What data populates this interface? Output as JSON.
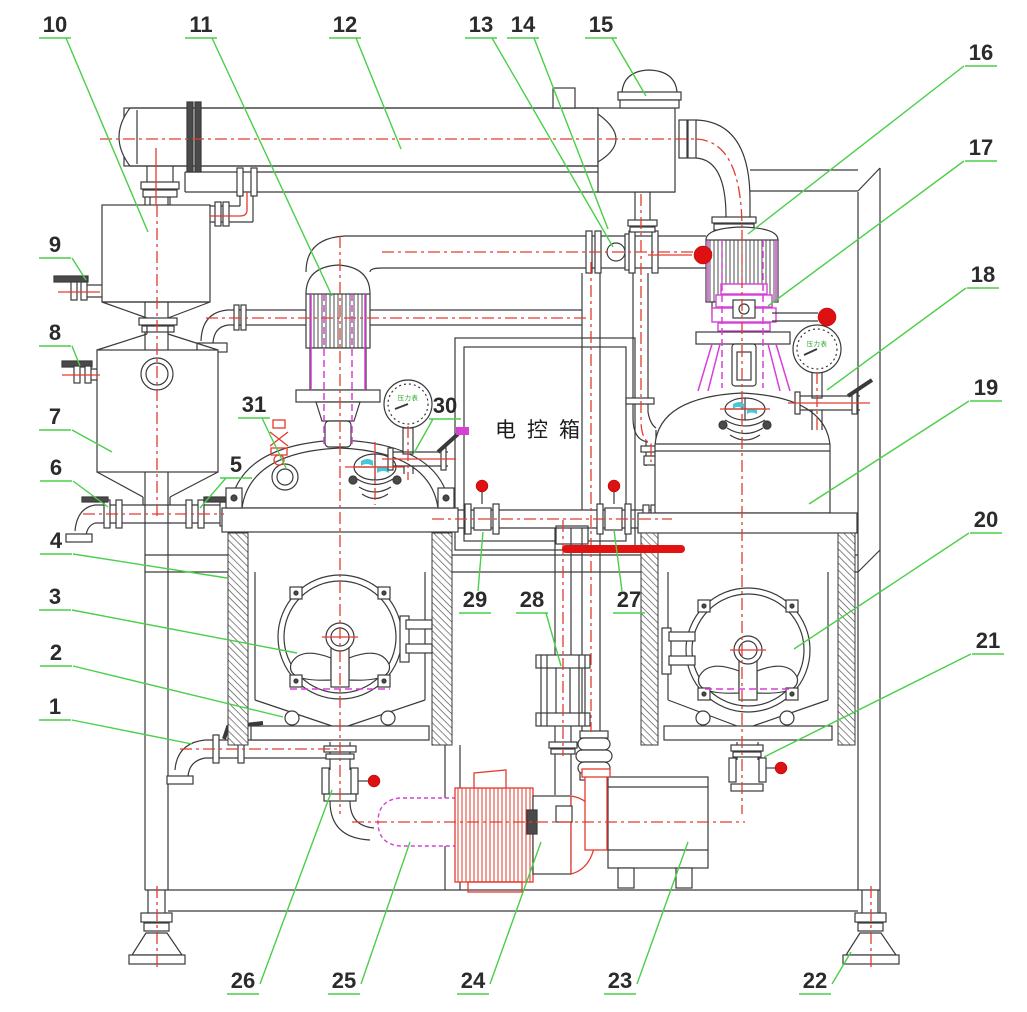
{
  "figure": {
    "type": "engineering-assembly-diagram",
    "control_box_label": "电控箱",
    "gauge_label": "压力表",
    "colors": {
      "leader_green": "#49cf49",
      "line_black": "#3a3a3a",
      "pipe_red": "#e23b30",
      "magenta": "#d640d6",
      "ball_red": "#dd1111",
      "bar_red": "#e01212",
      "cyan": "#45c8d8"
    },
    "callouts": [
      {
        "n": "1",
        "x": 55,
        "y": 714,
        "sx": 72,
        "sy": 720,
        "ex": 192,
        "ey": 744
      },
      {
        "n": "2",
        "x": 56,
        "y": 660,
        "sx": 73,
        "sy": 666,
        "ex": 283,
        "ey": 717
      },
      {
        "n": "3",
        "x": 55,
        "y": 604,
        "sx": 72,
        "sy": 610,
        "ex": 297,
        "ey": 653
      },
      {
        "n": "4",
        "x": 56,
        "y": 548,
        "sx": 73,
        "sy": 554,
        "ex": 227,
        "ey": 578
      },
      {
        "n": "5",
        "x": 236,
        "y": 472,
        "sx": 226,
        "sy": 478,
        "ex": 200,
        "ey": 508
      },
      {
        "n": "6",
        "x": 56,
        "y": 475,
        "sx": 73,
        "sy": 481,
        "ex": 108,
        "ey": 507
      },
      {
        "n": "7",
        "x": 55,
        "y": 424,
        "sx": 72,
        "sy": 430,
        "ex": 112,
        "ey": 452
      },
      {
        "n": "8",
        "x": 55,
        "y": 340,
        "sx": 72,
        "sy": 346,
        "ex": 80,
        "ey": 366
      },
      {
        "n": "9",
        "x": 55,
        "y": 252,
        "sx": 72,
        "sy": 258,
        "ex": 86,
        "ey": 280
      },
      {
        "n": "10",
        "x": 55,
        "y": 32,
        "sx": 66,
        "sy": 38,
        "ex": 148,
        "ey": 232
      },
      {
        "n": "11",
        "x": 201,
        "y": 32,
        "sx": 212,
        "sy": 38,
        "ex": 332,
        "ey": 296
      },
      {
        "n": "12",
        "x": 345,
        "y": 32,
        "sx": 356,
        "sy": 38,
        "ex": 401,
        "ey": 149
      },
      {
        "n": "13",
        "x": 481,
        "y": 32,
        "sx": 492,
        "sy": 38,
        "ex": 613,
        "ey": 247
      },
      {
        "n": "14",
        "x": 523,
        "y": 32,
        "sx": 534,
        "sy": 38,
        "ex": 608,
        "ey": 229
      },
      {
        "n": "15",
        "x": 601,
        "y": 32,
        "sx": 612,
        "sy": 38,
        "ex": 646,
        "ey": 96
      },
      {
        "n": "16",
        "x": 981,
        "y": 60,
        "sx": 964,
        "sy": 66,
        "ex": 748,
        "ey": 234
      },
      {
        "n": "17",
        "x": 981,
        "y": 155,
        "sx": 964,
        "sy": 161,
        "ex": 768,
        "ey": 306
      },
      {
        "n": "18",
        "x": 983,
        "y": 282,
        "sx": 966,
        "sy": 288,
        "ex": 827,
        "ey": 390
      },
      {
        "n": "19",
        "x": 986,
        "y": 395,
        "sx": 969,
        "sy": 401,
        "ex": 809,
        "ey": 504
      },
      {
        "n": "20",
        "x": 986,
        "y": 527,
        "sx": 969,
        "sy": 533,
        "ex": 794,
        "ey": 649
      },
      {
        "n": "21",
        "x": 988,
        "y": 648,
        "sx": 971,
        "sy": 654,
        "ex": 764,
        "ey": 757
      },
      {
        "n": "22",
        "x": 815,
        "y": 988,
        "sx": 832,
        "sy": 984,
        "ex": 851,
        "ey": 952
      },
      {
        "n": "23",
        "x": 620,
        "y": 988,
        "sx": 637,
        "sy": 984,
        "ex": 688,
        "ey": 842
      },
      {
        "n": "24",
        "x": 473,
        "y": 988,
        "sx": 490,
        "sy": 984,
        "ex": 541,
        "ey": 842
      },
      {
        "n": "25",
        "x": 344,
        "y": 988,
        "sx": 361,
        "sy": 984,
        "ex": 410,
        "ey": 842
      },
      {
        "n": "26",
        "x": 243,
        "y": 988,
        "sx": 260,
        "sy": 984,
        "ex": 332,
        "ey": 790
      },
      {
        "n": "27",
        "x": 629,
        "y": 607,
        "sx": 622,
        "sy": 591,
        "ex": 614,
        "ey": 530
      },
      {
        "n": "28",
        "x": 532,
        "y": 607,
        "sx": 546,
        "sy": 613,
        "ex": 561,
        "ey": 666
      },
      {
        "n": "29",
        "x": 475,
        "y": 607,
        "sx": 478,
        "sy": 591,
        "ex": 483,
        "ey": 532
      },
      {
        "n": "30",
        "x": 445,
        "y": 413,
        "sx": 433,
        "sy": 419,
        "ex": 414,
        "ey": 453
      },
      {
        "n": "31",
        "x": 254,
        "y": 412,
        "sx": 262,
        "sy": 418,
        "ex": 286,
        "ey": 468
      }
    ]
  }
}
